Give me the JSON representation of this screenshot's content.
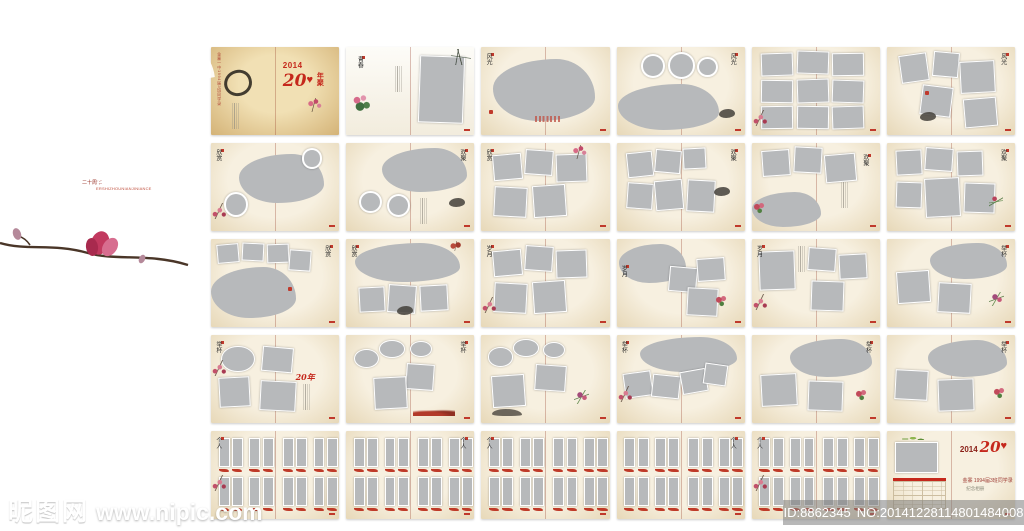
{
  "page": {
    "background": "#ffffff"
  },
  "banner": {
    "logo_number": "2",
    "year": "2014",
    "anniversary_note": "二十周年",
    "album_label": "纪念册",
    "pinyin_caption": "ERSHIZHOUNIANJINIANCE",
    "location": "金寨",
    "divider": "｜",
    "class_line": "1994届3班同学录",
    "features": [
      "分层文件",
      "300象素",
      "CDR文件",
      "可直接应用"
    ],
    "colors": {
      "banner_red": "#de2d1b",
      "stripe_red": "#a23428",
      "accent_red": "#c5281c",
      "placeholder_gray": "#b7b9bb"
    }
  },
  "watermark": {
    "site_name": "昵图网",
    "site_url": "www.nipic.com",
    "image_id": "ID:8862345",
    "image_no": "NO:20141228114801484008"
  },
  "album": {
    "red20_label": "20年",
    "cover": {
      "year": "2014",
      "title_number": "20",
      "title_chars": "年聚",
      "heart": "♥",
      "spine_text": "金寨一中1994届3班同学录"
    },
    "back": {
      "year": "2014",
      "title_number": "20",
      "heart": "♥",
      "line1": "金寨  1994届3班同学录",
      "line2": "纪念相册"
    },
    "spreads": [
      {
        "variant": "cover",
        "title": ""
      },
      {
        "variant": "intro",
        "title": "青春"
      },
      {
        "variant": "blobL",
        "title": "风光"
      },
      {
        "variant": "circles3",
        "title": "风光"
      },
      {
        "variant": "grid9",
        "title": ""
      },
      {
        "variant": "scatter5",
        "title": "风光"
      },
      {
        "variant": "blob2c",
        "title": "欣赏"
      },
      {
        "variant": "blobT2c",
        "title": "欢聚"
      },
      {
        "variant": "scatter5f",
        "title": "欣赏"
      },
      {
        "variant": "scatter6",
        "title": "欢聚"
      },
      {
        "variant": "rects3blobB",
        "title": "欢聚"
      },
      {
        "variant": "grid6",
        "title": "欢聚"
      },
      {
        "variant": "rects4blobBL",
        "title": "欣赏"
      },
      {
        "variant": "blobTrects3",
        "title": "欣赏"
      },
      {
        "variant": "scatter5p",
        "title": "岁月"
      },
      {
        "variant": "blobTLrects3",
        "title": "岁月"
      },
      {
        "variant": "big1r3",
        "title": "岁月"
      },
      {
        "variant": "blobTRr2x",
        "title": "举杯"
      },
      {
        "variant": "bubble1r3",
        "title": "举杯"
      },
      {
        "variant": "bubbles3r2",
        "title": "举杯"
      },
      {
        "variant": "bubbles3r3",
        "title": ""
      },
      {
        "variant": "blobTscatter4",
        "title": "举杯"
      },
      {
        "variant": "blobTRr2",
        "title": "举杯"
      },
      {
        "variant": "blobTRr2b",
        "title": "举杯"
      },
      {
        "variant": "personalP",
        "title": "个人"
      },
      {
        "variant": "personalR",
        "title": "个人"
      },
      {
        "variant": "personal",
        "title": "个人"
      },
      {
        "variant": "personalR",
        "title": "个人"
      },
      {
        "variant": "personalP",
        "title": "个人"
      },
      {
        "variant": "back",
        "title": ""
      }
    ]
  }
}
